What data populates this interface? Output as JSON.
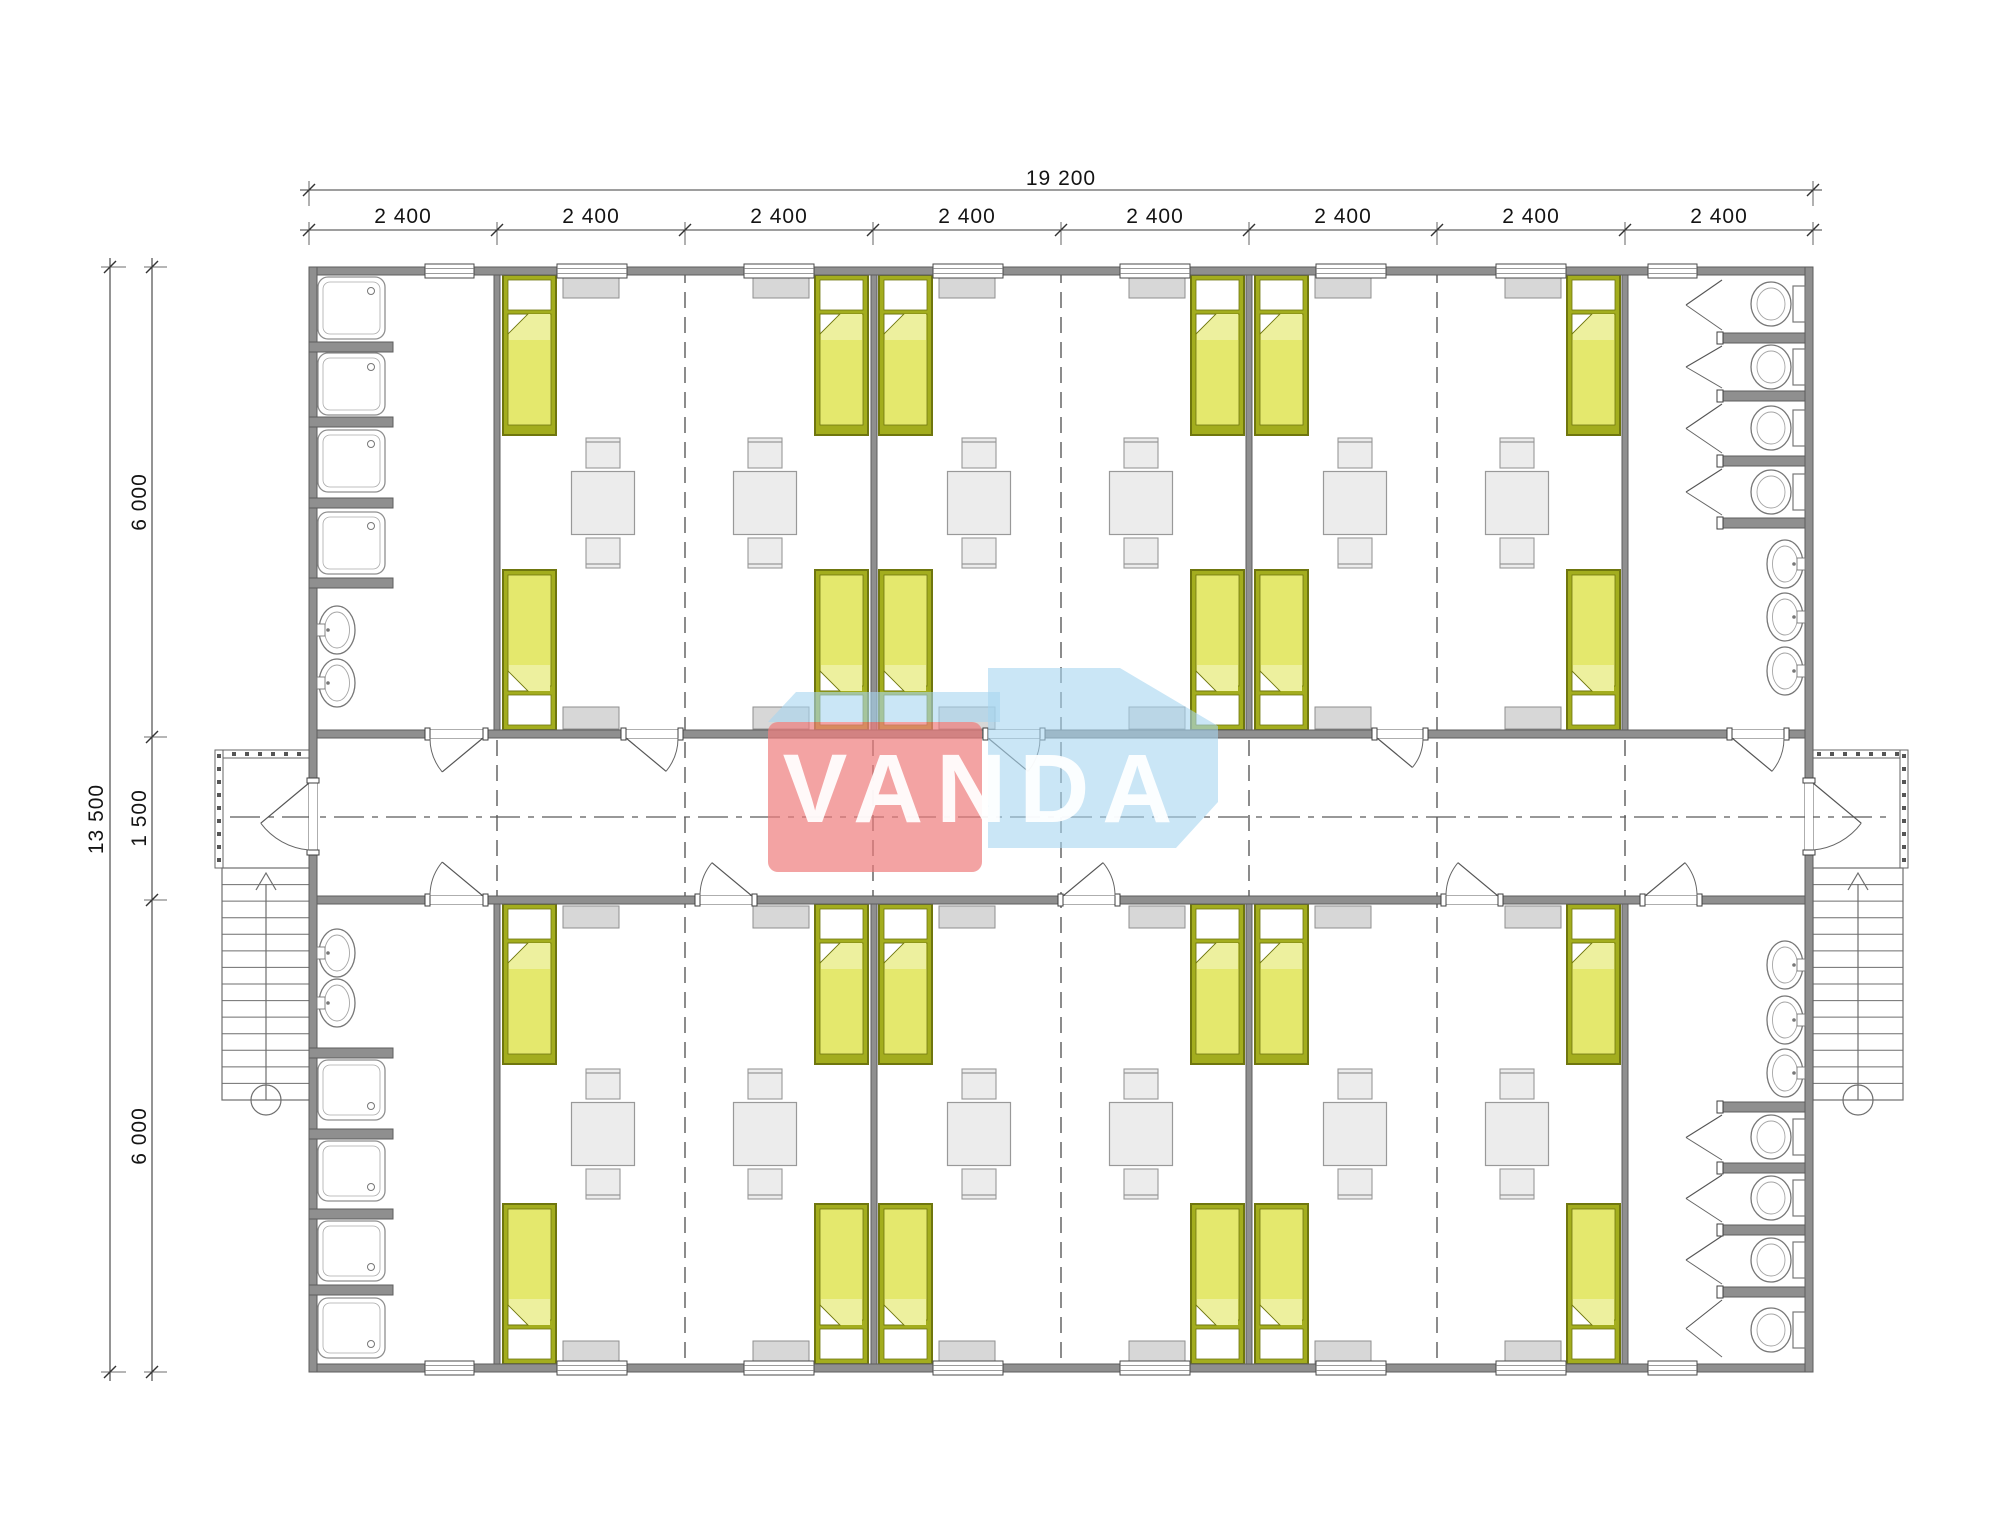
{
  "watermark": {
    "text": "VANDA",
    "red": "rgba(238,124,124,0.70)",
    "blue": "rgba(166,213,240,0.60)"
  },
  "dimensions": {
    "top_total": "19 200",
    "top_segments": [
      "2 400",
      "2 400",
      "2 400",
      "2 400",
      "2 400",
      "2 400",
      "2 400",
      "2 400"
    ],
    "left_total": "13 500",
    "left_segments": [
      "6 000",
      "1 500",
      "6 000"
    ]
  },
  "palette": {
    "wall": "#8f8f8f",
    "wallEdge": "#5d5d5d",
    "bedFrame": "#a3ad1e",
    "bedFrameEdge": "#6f760e",
    "bedSheet": "#e4e86d",
    "bedSheetLight": "#edf09e",
    "bedPillow": "#ffffff",
    "furn": "#ececec",
    "furnEdge": "#999999",
    "cabinet": "#d7d7d7",
    "cabinetEdge": "#8f8f8f",
    "fixture": "#777777",
    "fixtureInner": "#a5a5a5",
    "dash": "#5a5a5a",
    "dim": "#3c3c3c",
    "stair": "#6e6e6e"
  },
  "plan": {
    "building": {
      "x": 309,
      "y": 267,
      "w": 1504,
      "h": 1105,
      "wallT": 8
    },
    "walls": [
      [
        309,
        267,
        1504,
        8
      ],
      [
        309,
        1364,
        1504,
        8
      ],
      [
        309,
        267,
        8,
        1105
      ],
      [
        1805,
        267,
        8,
        1105
      ],
      [
        317,
        730,
        1488,
        8
      ],
      [
        317,
        896,
        1488,
        8
      ],
      [
        494,
        275,
        6,
        455
      ],
      [
        871,
        275,
        6,
        455
      ],
      [
        1246,
        275,
        6,
        455
      ],
      [
        1622,
        275,
        6,
        455
      ],
      [
        494,
        904,
        6,
        460
      ],
      [
        871,
        904,
        6,
        460
      ],
      [
        1246,
        904,
        6,
        460
      ],
      [
        1622,
        904,
        6,
        460
      ]
    ],
    "dash_full_x": [
      685,
      1061,
      1437
    ],
    "dash_corridor_x": [
      497,
      873,
      1249,
      1625
    ],
    "centerline": {
      "y": 817,
      "x1": 230,
      "x2": 1888
    },
    "bed_xs": [
      503,
      815,
      879,
      1191,
      1255,
      1567
    ],
    "bed_rows": [
      {
        "y": 275,
        "pillow": "top"
      },
      {
        "y": 570,
        "pillow": "bottom"
      },
      {
        "y": 904,
        "pillow": "top"
      },
      {
        "y": 1204,
        "pillow": "bottom"
      }
    ],
    "bed_w": 53,
    "bed_h": 160,
    "table_cxs": [
      603,
      765,
      979,
      1141,
      1355,
      1517
    ],
    "table_cys": [
      503,
      1134
    ],
    "table_s": 63,
    "cabinet_xs": [
      563,
      753,
      939,
      1129,
      1315,
      1505
    ],
    "cabinet_ys": [
      276,
      707,
      906,
      1341
    ],
    "cabinet_w": 56,
    "cabinet_h": 22,
    "window_rows": [
      264,
      1361
    ],
    "room_window_xs": [
      557,
      744,
      933,
      1120,
      1316,
      1496
    ],
    "room_window_w": 70,
    "san_window_xs": [
      425,
      1648
    ],
    "san_window_w": 49,
    "doors_h": [
      {
        "x1": 430,
        "x2": 483,
        "edge": "top",
        "hinge": "right"
      },
      {
        "x1": 626,
        "x2": 678,
        "edge": "top",
        "hinge": "left"
      },
      {
        "x1": 988,
        "x2": 1040,
        "edge": "top",
        "hinge": "left"
      },
      {
        "x1": 1377,
        "x2": 1423,
        "edge": "top",
        "hinge": "left"
      },
      {
        "x1": 1732,
        "x2": 1784,
        "edge": "top",
        "hinge": "left"
      },
      {
        "x1": 430,
        "x2": 483,
        "edge": "bottom",
        "hinge": "right"
      },
      {
        "x1": 700,
        "x2": 752,
        "edge": "bottom",
        "hinge": "right"
      },
      {
        "x1": 1063,
        "x2": 1115,
        "edge": "bottom",
        "hinge": "left"
      },
      {
        "x1": 1446,
        "x2": 1498,
        "edge": "bottom",
        "hinge": "right"
      },
      {
        "x1": 1645,
        "x2": 1697,
        "edge": "bottom",
        "hinge": "left"
      }
    ],
    "doors_v": [
      {
        "y1": 783,
        "y2": 850,
        "side": "left"
      },
      {
        "y1": 783,
        "y2": 850,
        "side": "right"
      }
    ],
    "shower_groups": [
      {
        "x": 318,
        "w": 67,
        "h": 62,
        "ys": [
          277,
          353,
          430,
          512
        ],
        "drain": "top"
      },
      {
        "x": 318,
        "w": 67,
        "h": 60,
        "ys": [
          1060,
          1141,
          1221,
          1298
        ],
        "drain": "bottom"
      }
    ],
    "shower_partitions": {
      "x": 309,
      "w": 84,
      "h": 10,
      "ys": [
        342,
        417,
        498,
        578,
        1048,
        1129,
        1209,
        1285
      ]
    },
    "toilet_partitions": {
      "x": 1720,
      "w": 85,
      "h": 10,
      "ys": [
        333,
        391,
        456,
        518,
        1102,
        1163,
        1225,
        1287
      ]
    },
    "toilet_cys": [
      304,
      367,
      428,
      492,
      1137,
      1198,
      1260,
      1330
    ],
    "stall_spans": [
      [
        277,
        333
      ],
      [
        343,
        391
      ],
      [
        401,
        456
      ],
      [
        466,
        518
      ],
      [
        1112,
        1163
      ],
      [
        1172,
        1225
      ],
      [
        1233,
        1287
      ],
      [
        1297,
        1360
      ]
    ],
    "sinks": [
      {
        "cy": 630,
        "side": "left"
      },
      {
        "cy": 683,
        "side": "left"
      },
      {
        "cy": 953,
        "side": "left"
      },
      {
        "cy": 1003,
        "side": "left"
      },
      {
        "cy": 564,
        "side": "right"
      },
      {
        "cy": 617,
        "side": "right"
      },
      {
        "cy": 671,
        "side": "right"
      },
      {
        "cy": 965,
        "side": "right"
      },
      {
        "cy": 1020,
        "side": "right"
      },
      {
        "cy": 1073,
        "side": "right"
      }
    ],
    "stairs": [
      {
        "x": 222,
        "y": 868,
        "w": 88,
        "h": 232,
        "cx": 266
      },
      {
        "x": 1813,
        "y": 868,
        "w": 90,
        "h": 232,
        "cx": 1858
      }
    ],
    "porches": [
      {
        "x": 215,
        "y": 750,
        "w": 94,
        "h": 118
      },
      {
        "x": 1813,
        "y": 750,
        "w": 95,
        "h": 118
      }
    ],
    "rails": [
      {
        "x": 215,
        "y": 750,
        "w": 94,
        "h": 8,
        "o": "h"
      },
      {
        "x": 215,
        "y": 750,
        "w": 8,
        "h": 118,
        "o": "v"
      },
      {
        "x": 1813,
        "y": 750,
        "w": 95,
        "h": 8,
        "o": "h"
      },
      {
        "x": 1900,
        "y": 750,
        "w": 8,
        "h": 118,
        "o": "v"
      }
    ],
    "dims": {
      "top_total_line": {
        "y": 190,
        "x1": 300,
        "x2": 1822,
        "ticks": [
          309,
          1813
        ]
      },
      "top_seg_line": {
        "y": 230,
        "x1": 300,
        "x2": 1822,
        "ticks": [
          309,
          497,
          685,
          873,
          1061,
          1249,
          1437,
          1625,
          1813
        ]
      },
      "left_total_line": {
        "x": 110,
        "y1": 258,
        "y2": 1381,
        "ticks": [
          267,
          1372
        ]
      },
      "left_seg_line": {
        "x": 152,
        "y1": 258,
        "y2": 1381,
        "ticks": [
          267,
          737,
          900,
          1372
        ]
      }
    },
    "wm_shapes": {
      "blue_strip": "768,722 796,692 1000,692 1000,722",
      "blue_block": "988,668 1120,668 1218,726 1218,802 1176,848 988,848",
      "red_block": {
        "x": 768,
        "y": 722,
        "w": 214,
        "h": 150,
        "r": 10
      }
    }
  }
}
